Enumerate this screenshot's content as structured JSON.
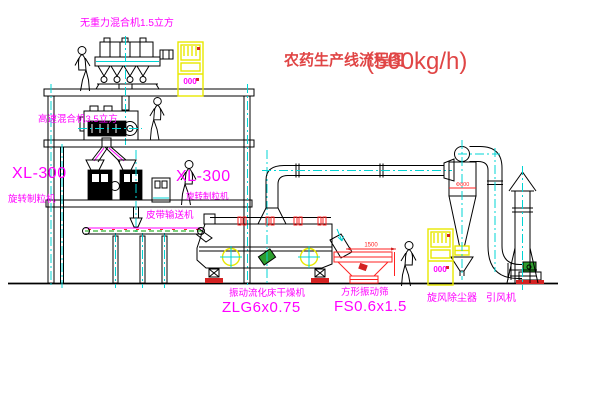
{
  "title": {
    "text": "农药生产线流程图",
    "capacity": "(500kg/h)"
  },
  "equipment_labels": {
    "gravity_mixer": "无重力混合机1.5立方",
    "high_speed_mixer": "高速混合机3.5立方",
    "granulator_left": {
      "model": "XL-300",
      "name": "旋转制粒机"
    },
    "granulator_right": {
      "model": "XL-300",
      "name": "旋转制粒机"
    },
    "belt_conveyor": "皮带输送机",
    "fluid_bed_dryer": {
      "name": "振动流化床干燥机",
      "model": "ZLG6x0.75"
    },
    "square_sifter": {
      "name": "方形振动筛",
      "model": "FS0.6x1.5"
    },
    "cyclone": "旋风除尘器",
    "induced_draft_fan": "引风机"
  },
  "dimensions": {
    "sifter_width": "1500",
    "cyclone_diameter": "Φ800"
  },
  "control_cabinets": {
    "display_left": "000",
    "display_right": "000"
  },
  "colors": {
    "label_magenta": "#FF00FF",
    "title_red": "#E04545",
    "line_black": "#000000",
    "centerline_cyan": "#00D4D4",
    "cabinet_yellow": "#E8E800",
    "dimension_red": "#FF2222",
    "conveyor_green": "#00A000"
  }
}
